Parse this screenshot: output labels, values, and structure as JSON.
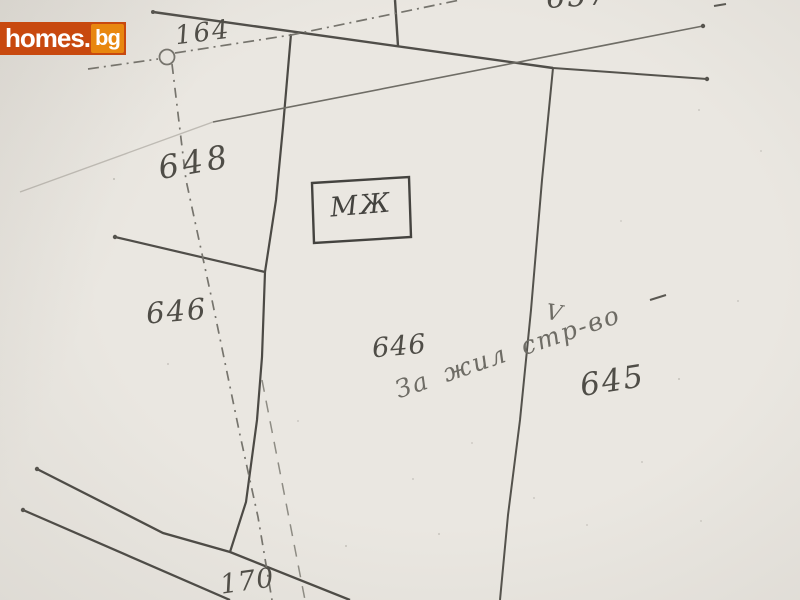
{
  "watermark": {
    "brand": "homes.",
    "tld": "bg"
  },
  "sketch": {
    "type": "cadastral-plan-scan",
    "labels": {
      "plot_164": "164",
      "plot_657": "657",
      "plot_648": "648",
      "plot_646_west": "646",
      "plot_646_main": "646",
      "plot_645": "645",
      "road_170": "170"
    },
    "building_label": "МЖ",
    "annotation": "За жил стр-во",
    "checkmark": "V",
    "colors": {
      "paper": "#eae7e1",
      "ink": "#4f4d47",
      "line": "#504e49",
      "logo_bg": "#c8490f",
      "logo_tld_bg": "#e8870f",
      "logo_text": "#ffffff"
    }
  }
}
